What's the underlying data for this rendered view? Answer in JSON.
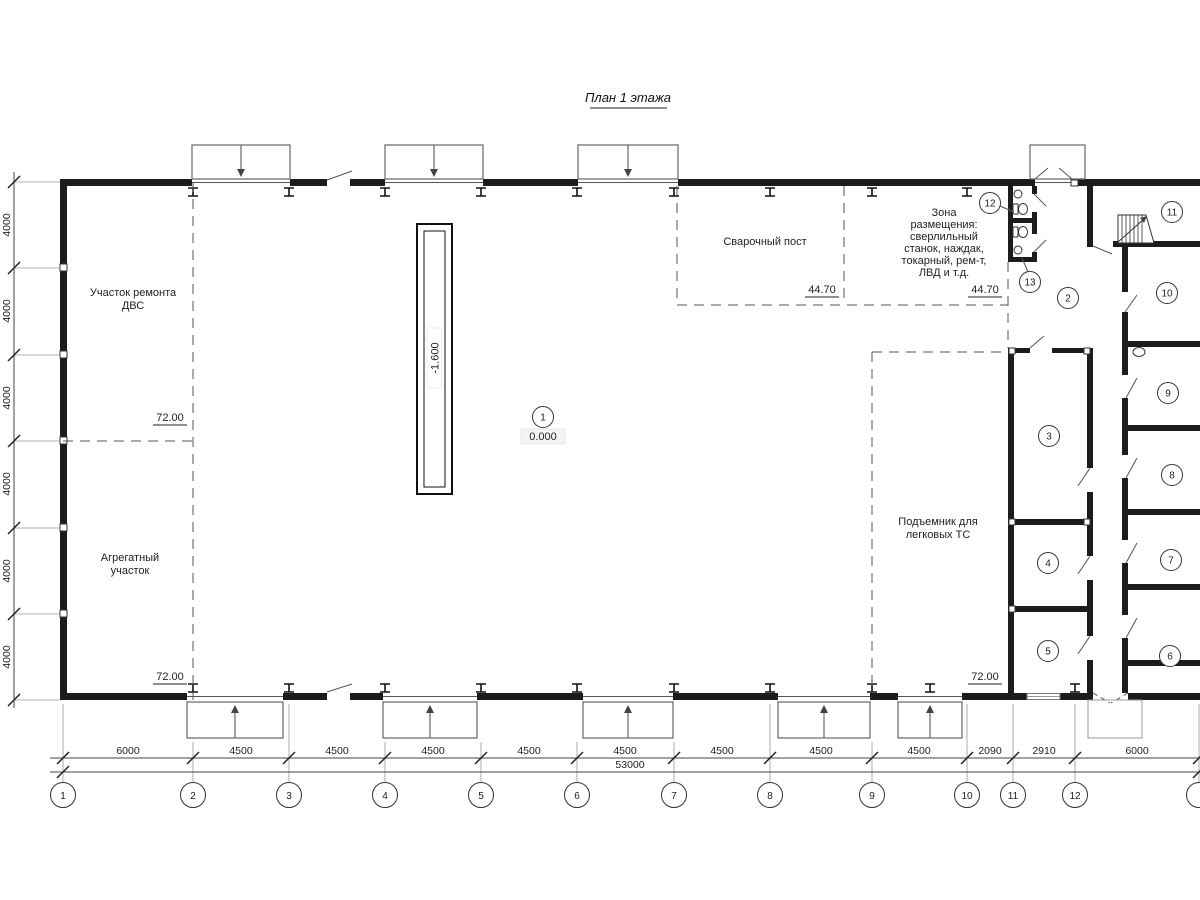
{
  "title": "План 1 этажа",
  "rooms": {
    "dvs_line1": "Участок ремонта",
    "dvs_line2": "ДВС",
    "agg_line1": "Агрегатный",
    "agg_line2": "участок",
    "weld": "Сварочный пост",
    "zone_lines": [
      "Зона",
      "размещения:",
      "сверлильный",
      "станок, наждак,",
      "токарный, рем-т,",
      "ЛВД и т.д."
    ],
    "lift_line1": "Подъемник для",
    "lift_line2": "легковых ТС"
  },
  "elevations": {
    "floor_main": "0.000",
    "pit": "-1.600",
    "e72_left_top": "72.00",
    "e72_left_bottom": "72.00",
    "e72_right": "72.00",
    "e44_weld": "44.70",
    "e44_zone": "44.70"
  },
  "marks": [
    "1",
    "2",
    "3",
    "4",
    "5",
    "6",
    "7",
    "8",
    "9",
    "10",
    "11",
    "12",
    "13"
  ],
  "grid_bubbles": [
    "1",
    "2",
    "3",
    "4",
    "5",
    "6",
    "7",
    "8",
    "9",
    "10",
    "11",
    "12"
  ],
  "dims_bottom": [
    "6000",
    "4500",
    "4500",
    "4500",
    "4500",
    "4500",
    "4500",
    "4500",
    "4500",
    "2090",
    "2910",
    "6000"
  ],
  "dim_total": "53000",
  "dims_left": [
    "4000",
    "4000",
    "4000",
    "4000",
    "4000",
    "4000"
  ]
}
